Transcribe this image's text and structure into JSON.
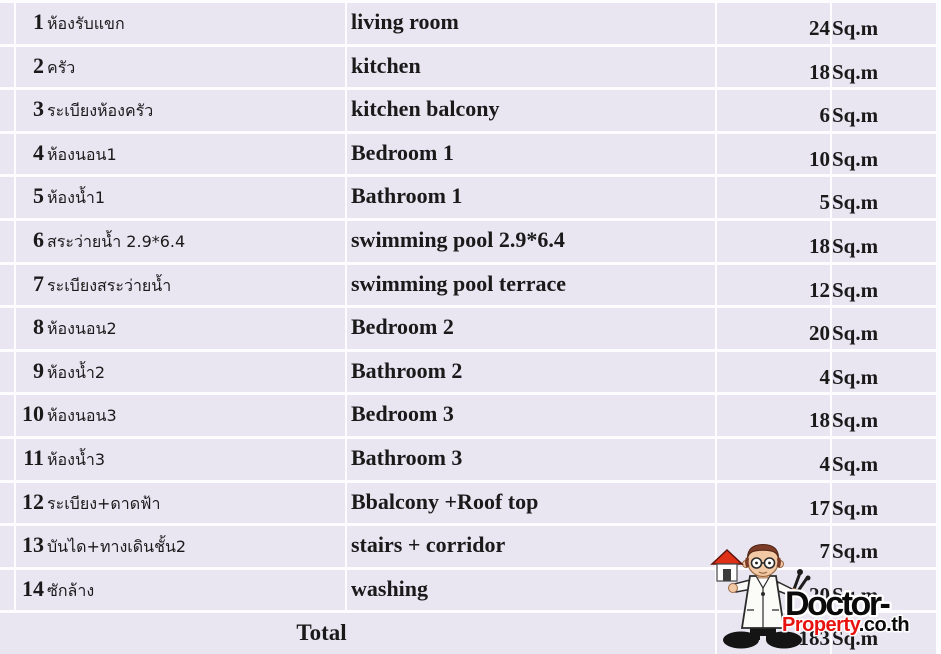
{
  "table": {
    "unit_label": "Sq.m",
    "rows": [
      {
        "no": "1",
        "thai": "ห้องรับแขก",
        "english": "living room",
        "area": "24"
      },
      {
        "no": "2",
        "thai": "ครัว",
        "english": "kitchen",
        "area": "18"
      },
      {
        "no": "3",
        "thai": "ระเบียงห้องครัว",
        "english": "kitchen balcony",
        "area": "6"
      },
      {
        "no": "4",
        "thai": "ห้องนอน1",
        "english": "Bedroom 1",
        "area": "10"
      },
      {
        "no": "5",
        "thai": "ห้องน้ำ1",
        "english": "Bathroom 1",
        "area": "5"
      },
      {
        "no": "6",
        "thai": "สระว่ายน้ำ 2.9*6.4",
        "english": "swimming pool 2.9*6.4",
        "area": "18"
      },
      {
        "no": "7",
        "thai": "ระเบียงสระว่ายน้ำ",
        "english": "swimming pool terrace",
        "area": "12"
      },
      {
        "no": "8",
        "thai": "ห้องนอน2",
        "english": "Bedroom 2",
        "area": "20"
      },
      {
        "no": "9",
        "thai": "ห้องน้ำ2",
        "english": "Bathroom 2",
        "area": "4"
      },
      {
        "no": "10",
        "thai": "ห้องนอน3",
        "english": "Bedroom 3",
        "area": "18"
      },
      {
        "no": "11",
        "thai": "ห้องน้ำ3",
        "english": "Bathroom 3",
        "area": "4"
      },
      {
        "no": "12",
        "thai": "ระเบียง+ดาดฟ้า",
        "english": "Bbalcony +Roof top",
        "area": "17"
      },
      {
        "no": "13",
        "thai": "บันได+ทางเดินชั้น2",
        "english": "stairs + corridor",
        "area": "7"
      },
      {
        "no": "14",
        "thai": "ซักล้าง",
        "english": "washing",
        "area": "20"
      }
    ],
    "total_label": "Total",
    "total_area": "183"
  },
  "logo": {
    "title": "Doctor-",
    "brand": "Property",
    "domain": ".co.th"
  },
  "colors": {
    "row_bg": "#e9e6f2",
    "separator": "#fdfdff",
    "text": "#1a1a1a",
    "logo_red": "#e8120e",
    "logo_black": "#0b0b0b",
    "house_roof_red": "#e03015"
  }
}
